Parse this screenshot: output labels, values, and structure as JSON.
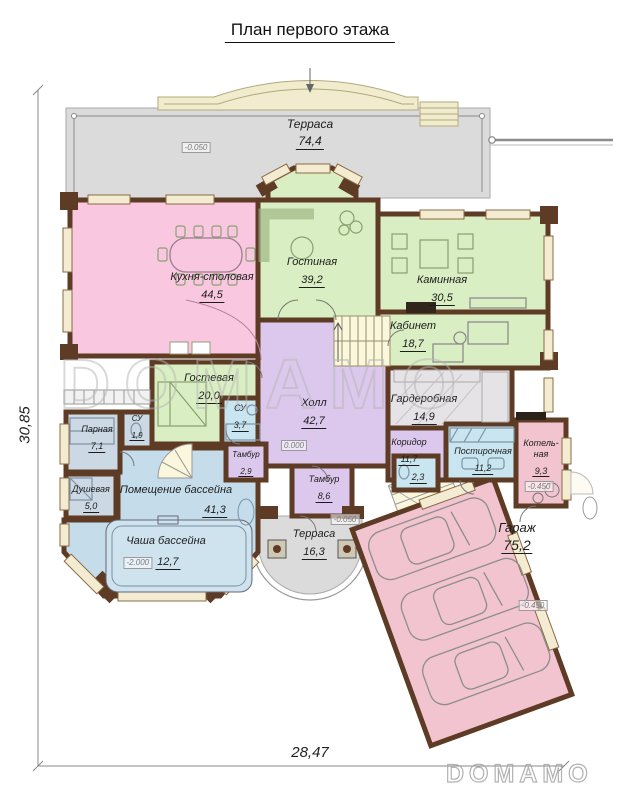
{
  "title": "План первого этажа",
  "watermarks": {
    "center": "DOMAMO",
    "corner": "DOMAMO"
  },
  "dimensions": {
    "left_height": "30,85",
    "bottom_width": "28,47"
  },
  "elevations": {
    "terrace_top": "-0.050",
    "hall": "0.000",
    "terrace_bottom": "-0.050",
    "boiler": "-0.450",
    "garage": "-0.450",
    "pool_basin": "-2.000"
  },
  "rooms": {
    "terrace_top": {
      "name": "Терраса",
      "area": "74,4"
    },
    "kitchen": {
      "name": "Кухня-столовая",
      "area": "44,5"
    },
    "living": {
      "name": "Гостиная",
      "area": "39,2"
    },
    "fireplace": {
      "name": "Каминная",
      "area": "30,5"
    },
    "office": {
      "name": "Кабинет",
      "area": "18,7"
    },
    "guest": {
      "name": "Гостевая",
      "area": "20,0"
    },
    "su_guest": {
      "name": "СУ",
      "area": "3,7"
    },
    "hall": {
      "name": "Холл",
      "area": "42,7"
    },
    "wardrobe": {
      "name": "Гардеробная",
      "area": "14,9"
    },
    "corridor": {
      "name": "Коридор",
      "area": "11,7"
    },
    "laundry": {
      "name": "Постирочная",
      "area": "11,2"
    },
    "boiler": {
      "name": "Котель-\nная",
      "area": "9,3"
    },
    "su_small": {
      "name": "",
      "area": "2,3"
    },
    "tambour_pool": {
      "name": "Тамбур",
      "area": "2,9"
    },
    "tambour_entry": {
      "name": "Тамбур",
      "area": "8,6"
    },
    "terrace_bottom": {
      "name": "Терраса",
      "area": "16,3"
    },
    "steam_room": {
      "name": "Парная",
      "area": "7,1"
    },
    "su_sauna": {
      "name": "СУ",
      "area": "1,9"
    },
    "shower": {
      "name": "Душевая",
      "area": "5,0"
    },
    "pool_room": {
      "name": "Помещение бассейна",
      "area": "41,3"
    },
    "pool_basin": {
      "name": "Чаша бассейна",
      "area": "12,7"
    },
    "garage": {
      "name": "Гараж",
      "area": "75,2"
    }
  },
  "colors": {
    "wall": "#5d3b24",
    "window": "#f3ecd2",
    "kitchen": "#f9c7e0",
    "green": "#daeec3",
    "lilac": "#dcc8ec",
    "pool": "#c5dcea",
    "bathBlue": "#c9e6f0",
    "sauna": "#ccd9e4",
    "garagePink": "#f1c4cf",
    "terrace": "#dbdbdb",
    "stairs": "#fbf7dc",
    "hatch": "#e6e3e7"
  }
}
